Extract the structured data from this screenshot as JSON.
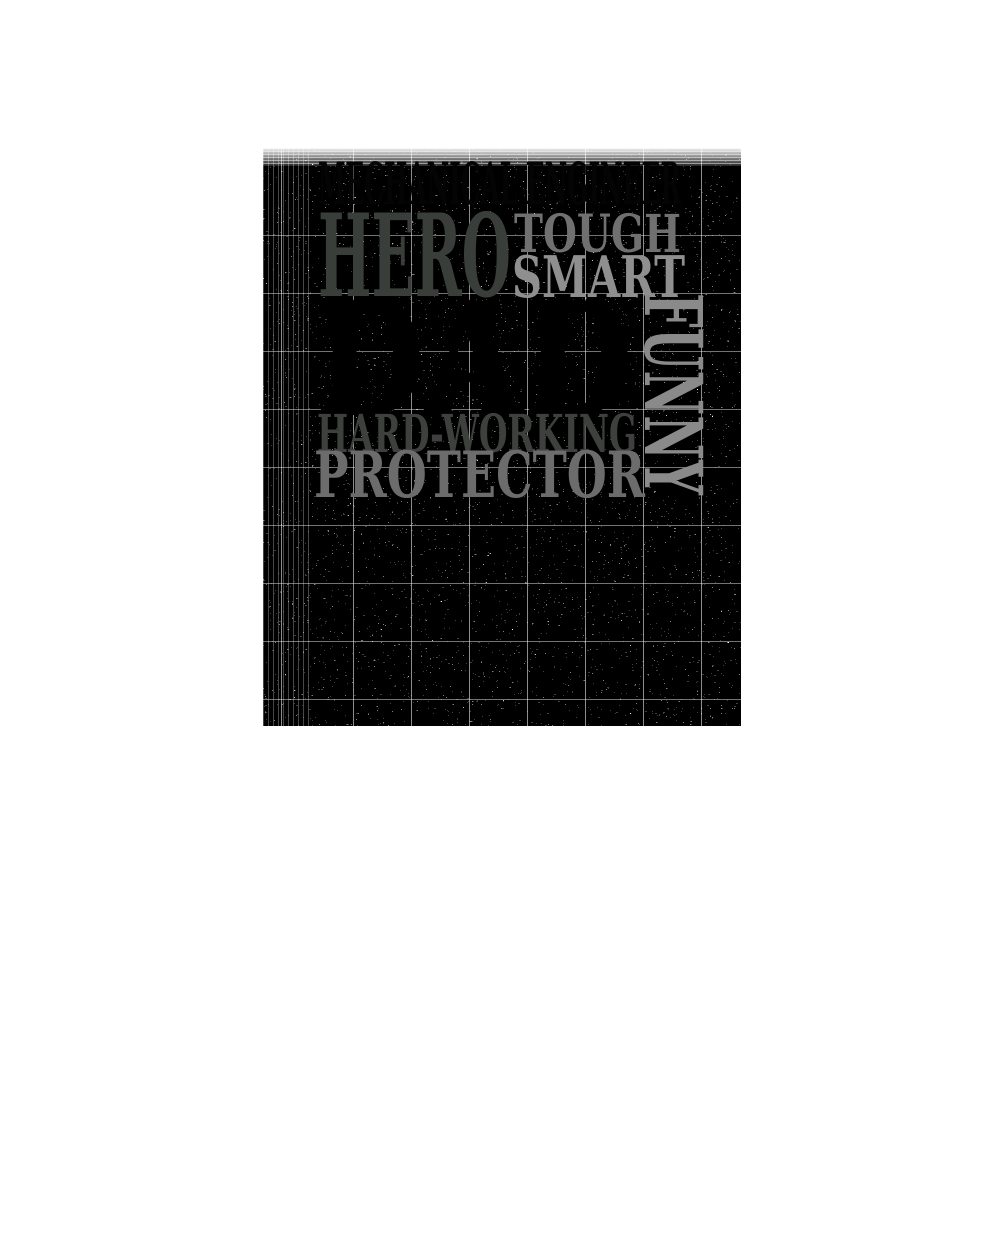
{
  "page": {
    "background_color": "#ffffff"
  },
  "design": {
    "texture": {
      "style": "black-and-white dithered speckle",
      "noise_color": "#000000",
      "seam_color": "#ffffff"
    },
    "words": {
      "top_line": {
        "label": "MECHANICAL ENGINEER",
        "color": "#040404"
      },
      "hero": {
        "label": "HERO",
        "color": "#3a3e3a"
      },
      "tough": {
        "label": "TOUGH",
        "color": "#707070"
      },
      "smart": {
        "label": "SMART",
        "color": "#8f8f8f"
      },
      "dad": {
        "label": "DAD",
        "color": "#000000"
      },
      "funny": {
        "label": "FUNNY",
        "color": "#8a8a8a"
      },
      "hard_working": {
        "label": "HARD-WORKING",
        "color": "#3d403d"
      },
      "protector": {
        "label": "PROTECTOR",
        "color": "#6c6c6c"
      }
    }
  }
}
